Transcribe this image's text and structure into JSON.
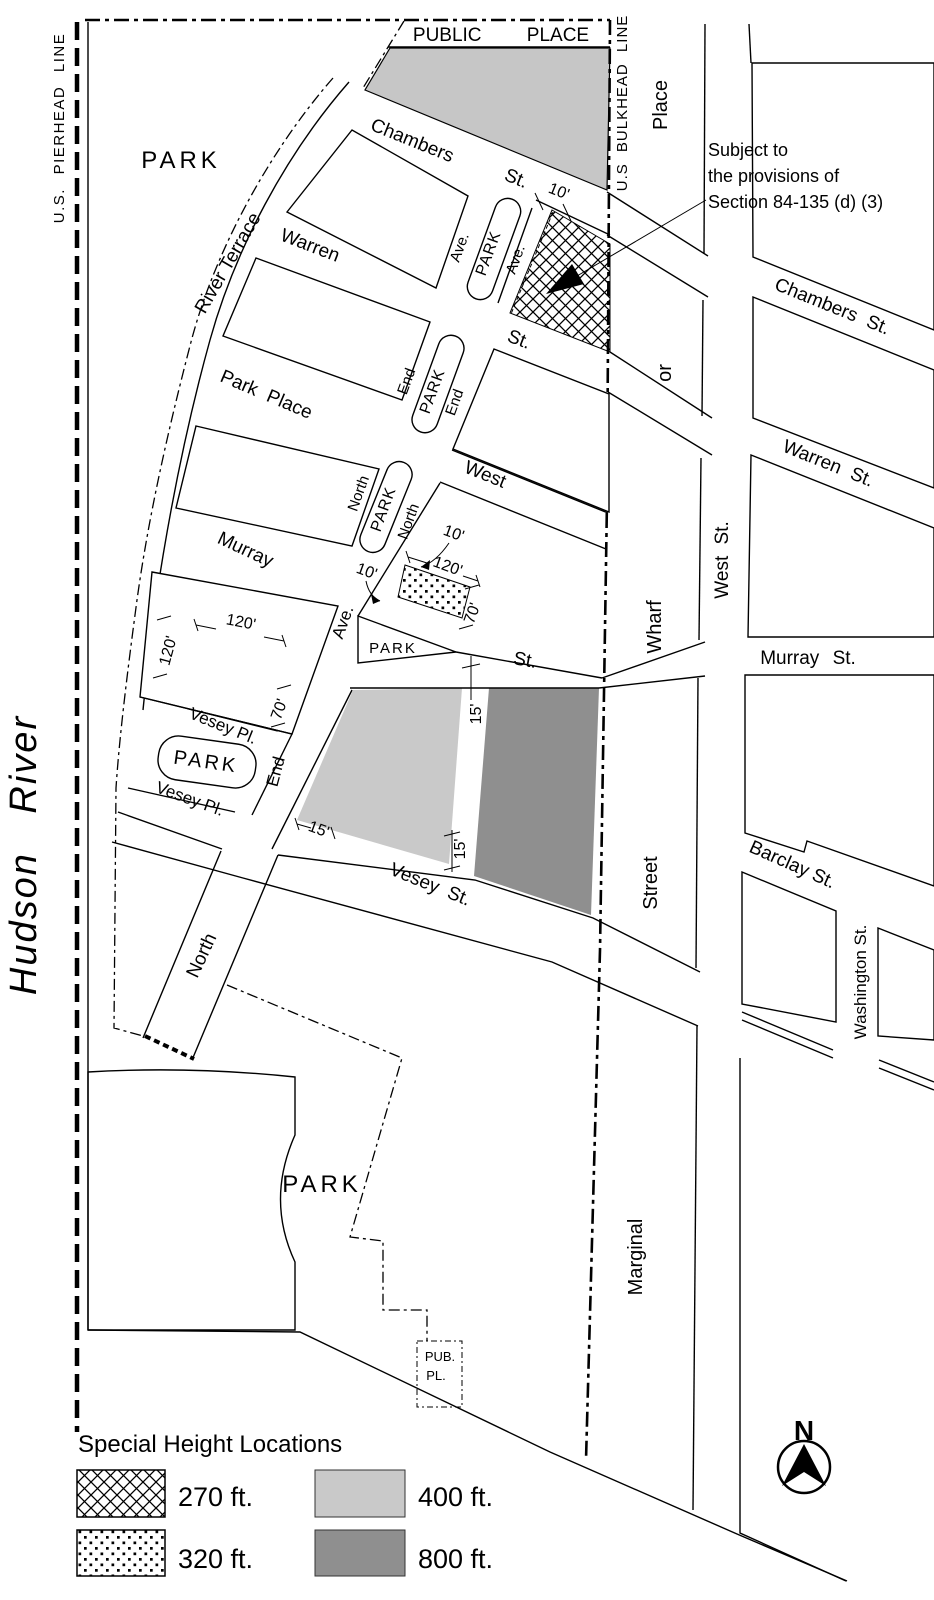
{
  "note": {
    "line1": "Subject to",
    "line2": "the provisions of",
    "line3": "Section 84-135 (d) (3)"
  },
  "water_labels": {
    "hudson_river": "Hudson River",
    "pierhead": "U.S. PIERHEAD LINE",
    "bulkhead": "U.S BULKHEAD LINE"
  },
  "streets": {
    "public_place": "PUBLIC PLACE",
    "chambers": "Chambers",
    "warren": "Warren",
    "park_place": "Park Place",
    "west": "West",
    "murray": "Murray",
    "vesey_pl": "Vesey Pl.",
    "vesey_st": "Vesey St.",
    "river_terrace": "River Terrace",
    "st_abbrev": "St.",
    "north": "North",
    "end": "End",
    "ave": "Ave.",
    "chambers_st": "Chambers St.",
    "warren_st": "Warren St.",
    "murray_st": "Murray St.",
    "barclay_st": "Barclay St.",
    "washington_st": "Washington St.",
    "west_st": "West St.",
    "marginal": "Marginal",
    "street": "Street",
    "wharf": "Wharf",
    "or": "or",
    "place": "Place",
    "pub": "PUB.",
    "pl": "PL."
  },
  "park_label": "PARK",
  "dims": {
    "ten": "10'",
    "fifteen": "15'",
    "seventy": "70'",
    "one_twenty": "120'"
  },
  "legend": {
    "title": "Special Height Locations",
    "items": [
      {
        "swatch": "crosshatch",
        "label": "270 ft."
      },
      {
        "swatch": "dots",
        "label": "320 ft."
      },
      {
        "swatch": "solid-light",
        "label": "400 ft."
      },
      {
        "swatch": "solid-dark",
        "label": "800 ft."
      }
    ]
  },
  "compass": {
    "north": "N"
  },
  "colors": {
    "light_gray": "#c9c9c9",
    "dark_gray": "#8f8f8f",
    "public_place_gray": "#c6c6c6"
  }
}
